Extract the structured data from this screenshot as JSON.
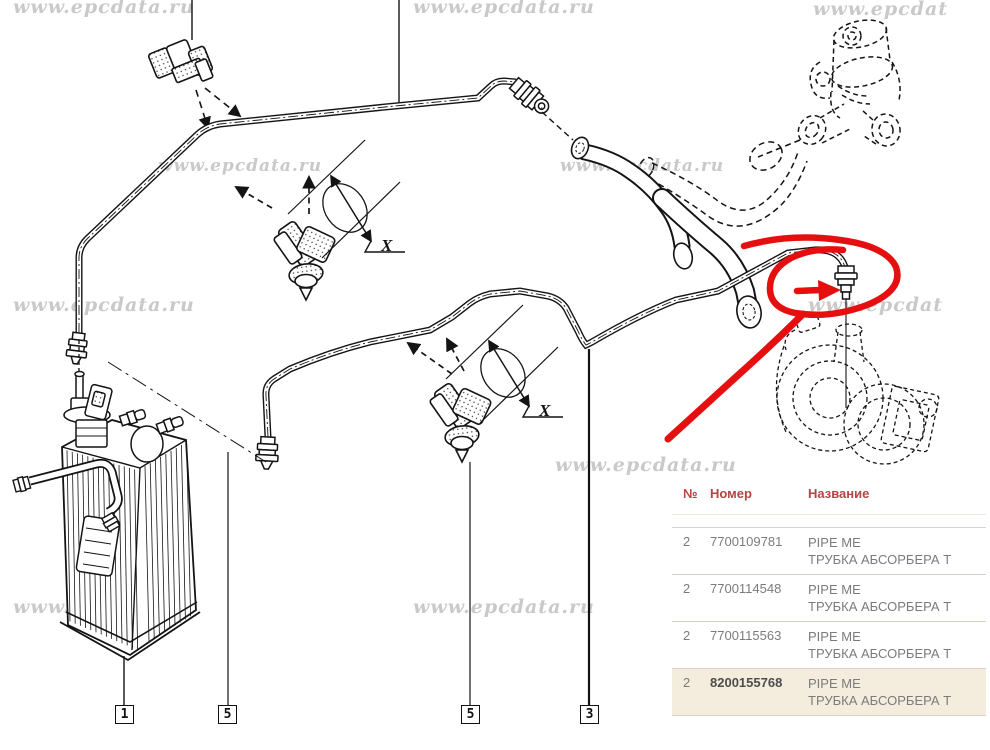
{
  "diagram": {
    "watermarks": [
      {
        "text": "www.epcdata.ru"
      },
      {
        "text": "www.epcdata.ru"
      },
      {
        "text": "www.epcdat"
      },
      {
        "text": "www.epcdata.ru"
      },
      {
        "text": "www.epcdata.ru"
      },
      {
        "text": "www.epcdata.ru"
      },
      {
        "text": "www.epcdat"
      },
      {
        "text": "www.epcdata.ru"
      },
      {
        "text": "www.epcdata.ru"
      },
      {
        "text": "www.epcdata.ru"
      }
    ],
    "callout_labels": {
      "x1": "X",
      "x2": "X"
    },
    "part_boxes": [
      {
        "label": "1"
      },
      {
        "label": "5"
      },
      {
        "label": "5"
      },
      {
        "label": "3"
      }
    ],
    "colors": {
      "line": "#141414",
      "watermark": "#c9c9c9",
      "annotation_red": "#e60f0f"
    }
  },
  "parts_table": {
    "headers": {
      "num": "№",
      "number": "Номер",
      "name": "Название"
    },
    "header_color": "#b34545",
    "highlight_bg": "#f4ecdd",
    "row_text_color": "#7b7b7b",
    "rows": [
      {
        "qty": "2",
        "number": "7700109781",
        "name_en": "PIPE ME",
        "name_ru": "ТРУБКА АБСОРБЕРА Т"
      },
      {
        "qty": "2",
        "number": "7700114548",
        "name_en": "PIPE ME",
        "name_ru": "ТРУБКА АБСОРБЕРА Т"
      },
      {
        "qty": "2",
        "number": "7700115563",
        "name_en": "PIPE ME",
        "name_ru": "ТРУБКА АБСОРБЕРА Т"
      },
      {
        "qty": "2",
        "number": "8200155768",
        "name_en": "PIPE ME",
        "name_ru": "ТРУБКА АБСОРБЕРА Т"
      }
    ]
  }
}
